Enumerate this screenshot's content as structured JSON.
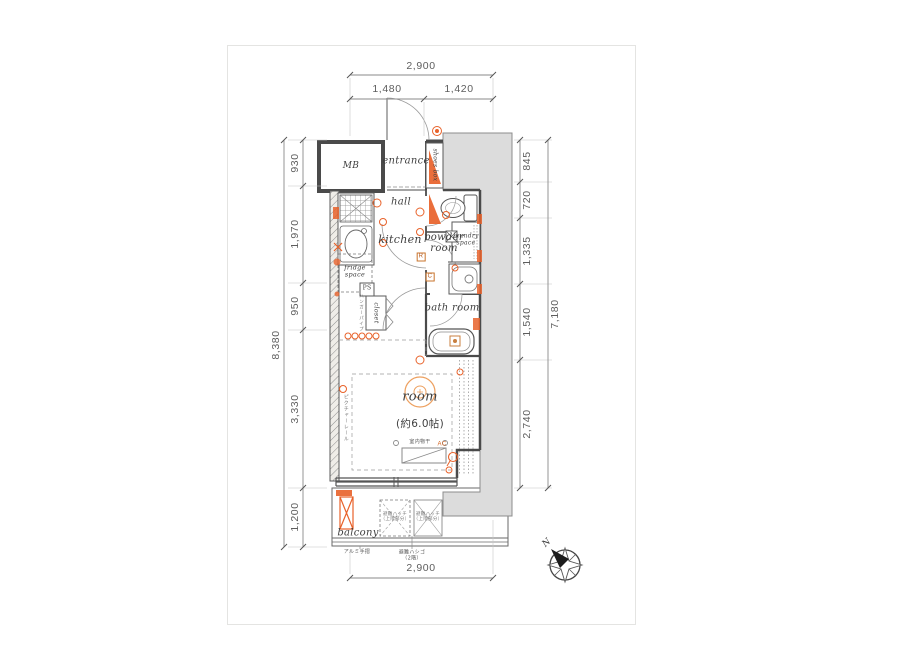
{
  "dims": {
    "top_total": "2,900",
    "top_left": "1,480",
    "top_right": "1,420",
    "left_segments": [
      "930",
      "1,970",
      "950",
      "3,330",
      "1,200"
    ],
    "left_total": "8,380",
    "right_segments": [
      "845",
      "720",
      "1,335",
      "1,540",
      "2,740"
    ],
    "right_total": "7,180",
    "bottom_total": "2,900"
  },
  "rooms": {
    "mb": "MB",
    "entrance": "entrance",
    "shoes_box": "shoes box",
    "hall": "hall",
    "kitchen": "kitchen",
    "fridge_space": "fridge\nspace",
    "ps": "PS",
    "closet": "closet",
    "powder_room": "powder\nroom",
    "laundry_space": "laundry\nspace",
    "bath_room": "bath room",
    "room": "room",
    "room_size": "(約6.0帖)",
    "balcony": "balcony"
  },
  "annotations": {
    "indoor_drying": "室内物干",
    "ac": "AC",
    "r_mark": "R",
    "c_mark": "C",
    "hatch_label": "避難ハッチ\n（上階部分）",
    "handrail": "アルミ手摺",
    "ladder": "避難ハシゴ\n（2階）",
    "picture_rail": "ピクチャーレール",
    "hanger_pipe": "ハンガーパイプ",
    "compass_n": "N"
  },
  "colors": {
    "accent": "#e8622a",
    "accent_light": "#eda05f",
    "wall": "#4a4a4a",
    "gray_area": "#dcdcdc"
  }
}
